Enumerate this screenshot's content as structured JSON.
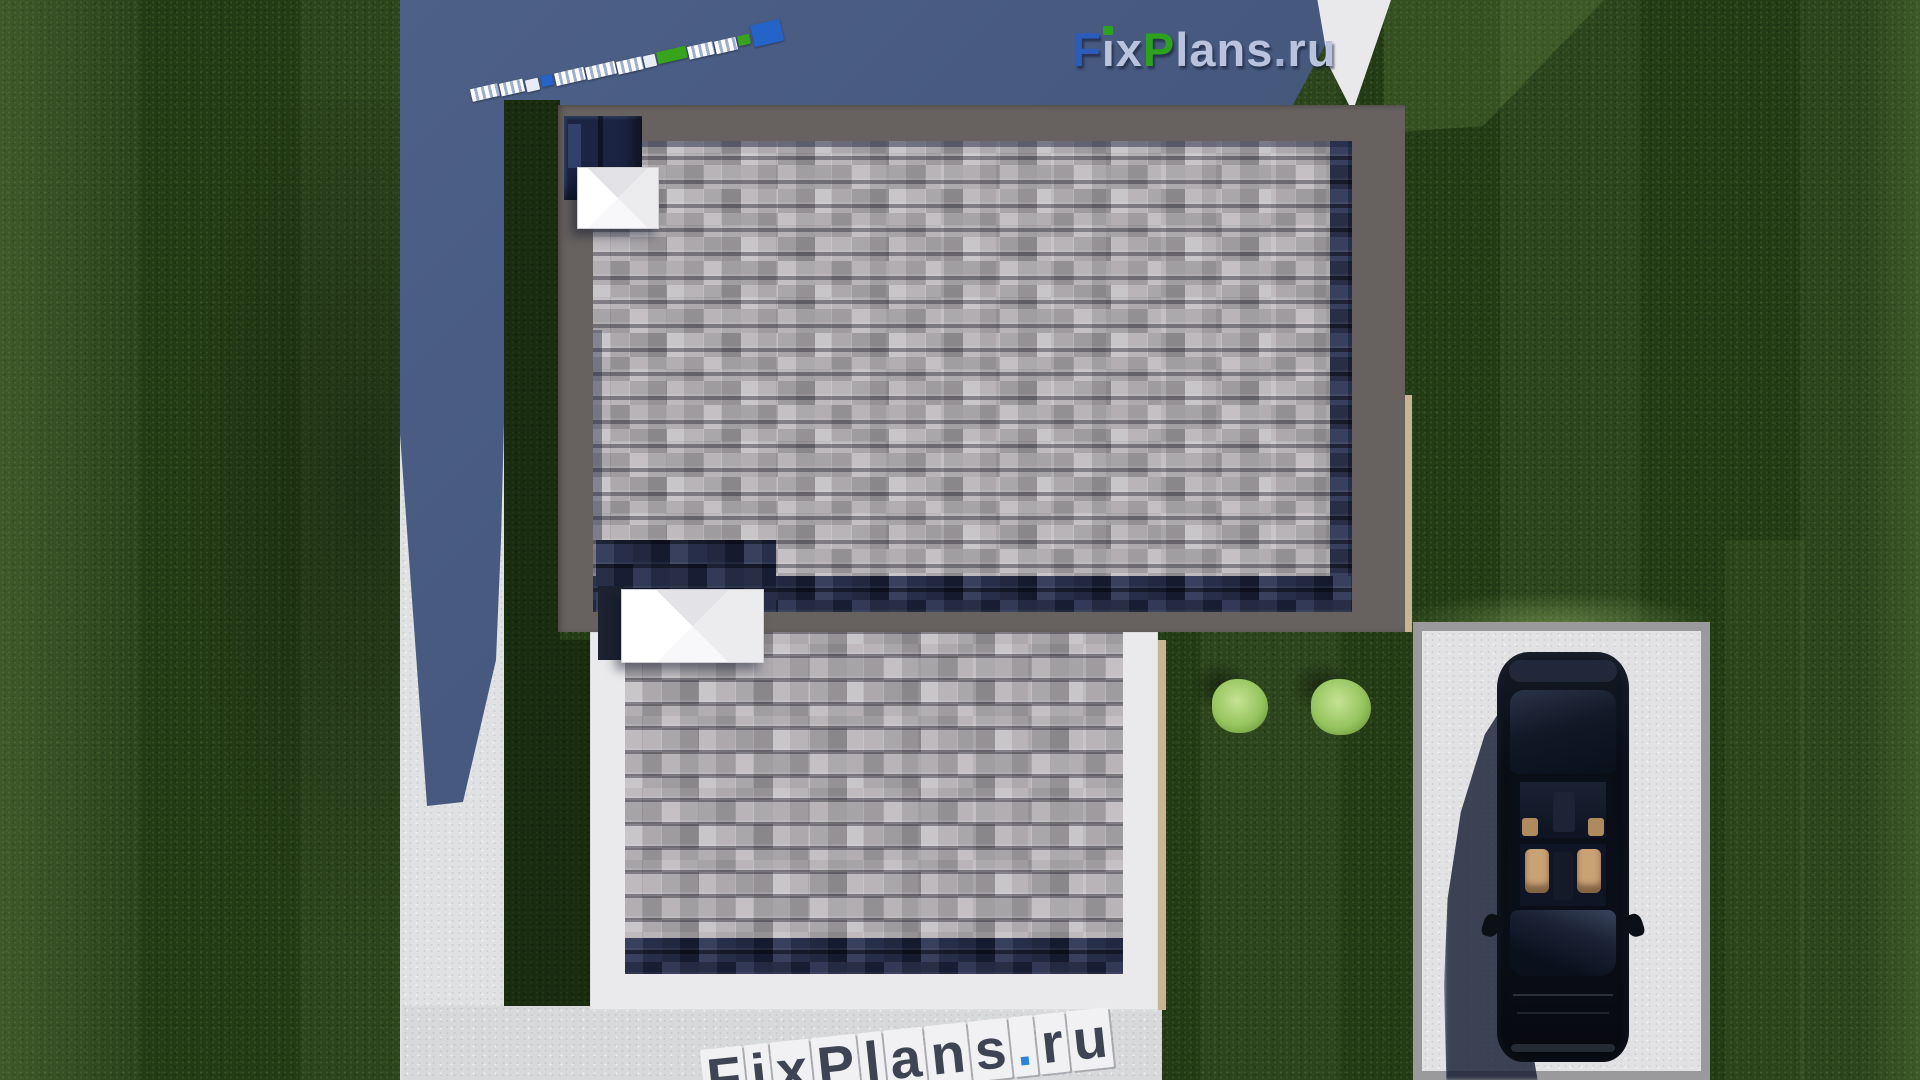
{
  "scene": {
    "description": "Top-down 3D render of a flat-roof house plot: gray shingle roofs, white concrete paths and patio, lawn, parking pad with black sedan, two bushes, FixPlans.ru watermarks",
    "palette": {
      "grass": "#263f16",
      "grass_shadow": "#1a2c10",
      "terrace_shadow_blue": "#47597e",
      "path_concrete": "#e0e1e3",
      "patio_concrete": "#d8d9db",
      "roof_parapet_gray": "#676260",
      "shingle_gray": "#b4b0b3",
      "shingle_shadow_navy": "#232c49",
      "lower_roof_border_white": "#eaeaec",
      "chimney_white": "#f4f4f6",
      "driveway_white": "#e2e2e4",
      "driveway_border_gray": "#9a999b",
      "edge_tan": "#c9b493",
      "bush_green": "#a3cb70",
      "car_black": "#0b0e16",
      "car_interior_tan": "#c9a276"
    },
    "logo_top": {
      "text": "FixPlans.ru",
      "letters": [
        {
          "ch": "F",
          "color": "#2b5cb9"
        },
        {
          "ch": "ı",
          "color": "#b9c3de",
          "dot": "#2ba321"
        },
        {
          "ch": "x",
          "color": "#b9c3de"
        },
        {
          "ch": "P",
          "color": "#2ca21e"
        },
        {
          "ch": "l",
          "color": "#b9c3de"
        },
        {
          "ch": "a",
          "color": "#b9c3de"
        },
        {
          "ch": "n",
          "color": "#b9c3de"
        },
        {
          "ch": "s",
          "color": "#b9c3de"
        },
        {
          "ch": ".",
          "color": "#a5b0d0"
        },
        {
          "ch": "r",
          "color": "#b9c3de"
        },
        {
          "ch": "u",
          "color": "#b9c3de"
        }
      ]
    },
    "watermark_bottom": {
      "text": "FixPlans.ru",
      "letter_color": "#3e4453",
      "block_color": "#f1f1f3",
      "dot_color": "#2e82d8"
    },
    "deco_blocks": [
      {
        "x": 471,
        "y": 86,
        "w": 28,
        "h": 13,
        "c": "white",
        "s": true
      },
      {
        "x": 500,
        "y": 81,
        "w": 24,
        "h": 13,
        "c": "white",
        "s": true
      },
      {
        "x": 526,
        "y": 79,
        "w": 13,
        "h": 12,
        "c": "white",
        "s": false
      },
      {
        "x": 541,
        "y": 75,
        "w": 12,
        "h": 11,
        "c": "blue",
        "s": false
      },
      {
        "x": 555,
        "y": 70,
        "w": 30,
        "h": 13,
        "c": "white",
        "s": true
      },
      {
        "x": 586,
        "y": 64,
        "w": 30,
        "h": 13,
        "c": "white",
        "s": true
      },
      {
        "x": 617,
        "y": 59,
        "w": 26,
        "h": 13,
        "c": "white",
        "s": true
      },
      {
        "x": 644,
        "y": 55,
        "w": 12,
        "h": 12,
        "c": "white",
        "s": false
      },
      {
        "x": 657,
        "y": 49,
        "w": 30,
        "h": 12,
        "c": "green",
        "s": false
      },
      {
        "x": 688,
        "y": 44,
        "w": 26,
        "h": 13,
        "c": "white",
        "s": true
      },
      {
        "x": 715,
        "y": 39,
        "w": 22,
        "h": 13,
        "c": "white",
        "s": true
      },
      {
        "x": 738,
        "y": 35,
        "w": 12,
        "h": 10,
        "c": "green",
        "s": false
      },
      {
        "x": 752,
        "y": 22,
        "w": 30,
        "h": 22,
        "c": "blue",
        "s": false
      }
    ],
    "bushes": [
      {
        "cx": 1240,
        "cy": 706,
        "rx": 28,
        "ry": 27
      },
      {
        "cx": 1341,
        "cy": 707,
        "rx": 30,
        "ry": 28
      }
    ],
    "car": {
      "type": "sedan-top-view",
      "facing": "down",
      "body_color": "#0b0e16",
      "interior_color": "#c9a276"
    }
  }
}
